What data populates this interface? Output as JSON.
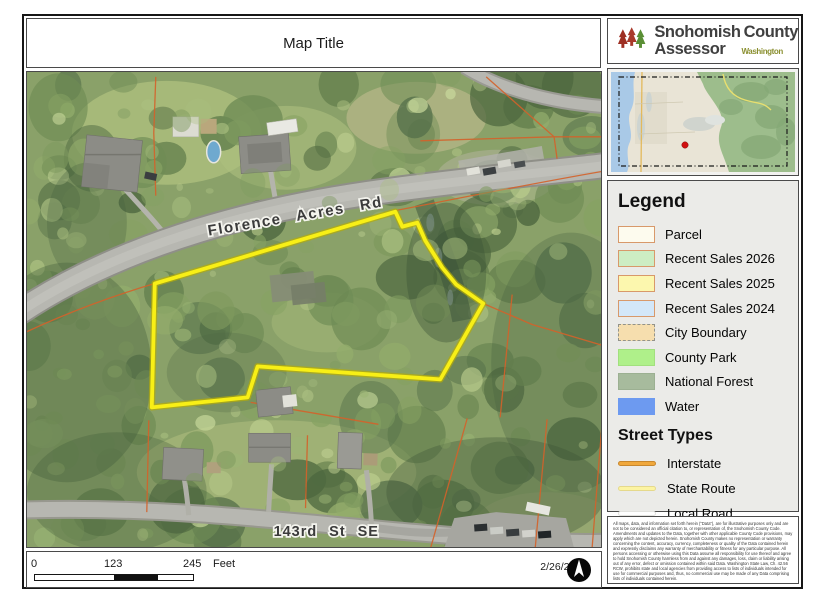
{
  "page": {
    "title": "Map Title"
  },
  "logo": {
    "name_part1": "Snohomish",
    "name_part2": "County",
    "name_part3": "Assessor",
    "state": "Washington"
  },
  "map_labels": {
    "main_road": "Florence Acres Rd",
    "bottom_road": "143rd St SE"
  },
  "legend": {
    "title": "Legend",
    "items": [
      {
        "label": "Parcel",
        "fill": "#fdfbee",
        "border": "#d8996a",
        "border_style": "solid"
      },
      {
        "label": "Recent Sales 2026",
        "fill": "#cdedc3",
        "border": "#d8996a",
        "border_style": "solid"
      },
      {
        "label": "Recent Sales 2025",
        "fill": "#fcf7ae",
        "border": "#d8996a",
        "border_style": "solid"
      },
      {
        "label": "Recent Sales 2024",
        "fill": "#d3e7f8",
        "border": "#d8996a",
        "border_style": "solid"
      },
      {
        "label": "City Boundary",
        "fill": "#f6deae",
        "border": "#93938a",
        "border_style": "dashed"
      },
      {
        "label": "County Park",
        "fill": "#aff08a",
        "border": "#a2e07e",
        "border_style": "solid"
      },
      {
        "label": "National Forest",
        "fill": "#a7bb9d",
        "border": "#9cb092",
        "border_style": "solid"
      },
      {
        "label": "Water",
        "fill": "#6d9af0",
        "border": "#6d9af0",
        "border_style": "solid"
      }
    ],
    "street_types_title": "Street Types",
    "street_types": [
      {
        "label": "Interstate",
        "fill": "#f0a83c",
        "casing": "#c8872d"
      },
      {
        "label": "State Route",
        "fill": "#fcf4a2",
        "casing": "#e5d98c"
      },
      {
        "label": "Local Road",
        "fill": "#ffffff",
        "casing": "#e2e2de"
      }
    ]
  },
  "scale_bar": {
    "tick_start": "0",
    "tick_mid": "123",
    "tick_end": "245",
    "unit": "Feet"
  },
  "footer": {
    "date": "2/26/2026"
  },
  "parcel_highlight_color": "#f8ef16",
  "disclaimer": "All maps, data, and information set forth herein (\"Data\"), are for illustrative purposes only and are not to be considered an official citation to, or representation of, the Snohomish County Code. Amendments and updates to the Data, together with other applicable County Code provisions, may apply which are not depicted herein. Snohomish County makes no representation or warranty concerning the content, accuracy, currency, completeness or quality of the Data contained herein and expressly disclaims any warranty of merchantability or fitness for any particular purpose. All persons accessing or otherwise using this Data assume all responsibility for use thereof and agree to hold Snohomish County harmless from and against any damages, loss, claim or liability arising out of any error, defect or omission contained within said Data. Washington State Law, Ch. 42.56 RCW, prohibits state and local agencies from providing access to lists of individuals intended for use for commercial purposes and, thus, no commercial use may be made of any Data comprising lists of individuals contained herein."
}
